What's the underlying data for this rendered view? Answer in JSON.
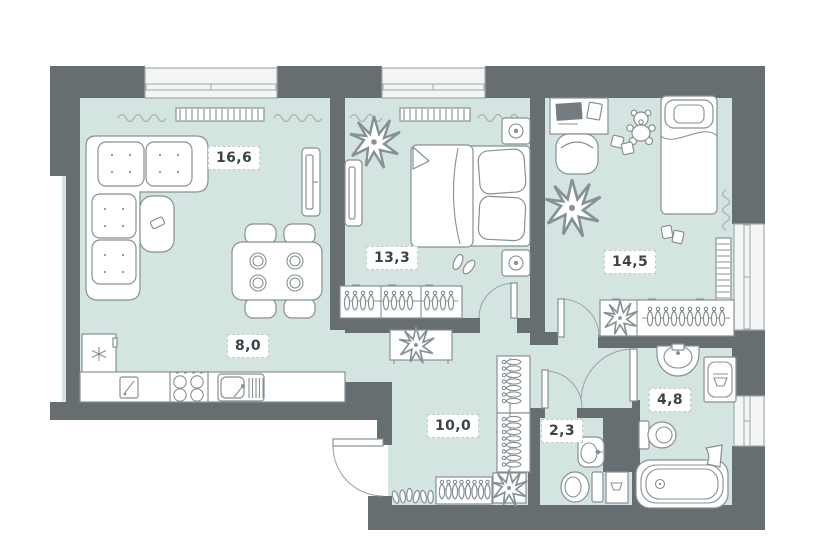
{
  "rooms": [
    {
      "id": "living-room",
      "area": "16,6"
    },
    {
      "id": "bedroom",
      "area": "13,3"
    },
    {
      "id": "kids-room",
      "area": "14,5"
    },
    {
      "id": "kitchen",
      "area": "8,0"
    },
    {
      "id": "hallway",
      "area": "10,0"
    },
    {
      "id": "wc",
      "area": "2,3"
    },
    {
      "id": "bathroom",
      "area": "4,8"
    }
  ],
  "colors": {
    "wall": "#676e72",
    "floor": "#d4e4e0",
    "window": "#f4f5f5",
    "outline": "#879093",
    "label_bg": "#ffffff",
    "label_border": "#bfc9c8",
    "label_text": "#3a444a"
  },
  "icons": [
    "sofa-icon",
    "coffee-table-icon",
    "tv-icon",
    "dining-table-icon",
    "chair-icon",
    "fridge-icon",
    "stove-icon",
    "sink-icon",
    "cutting-board-icon",
    "bed-double-icon",
    "bed-single-icon",
    "nightstand-icon",
    "lamp-icon",
    "wardrobe-icon",
    "hanger-icon",
    "plant-icon",
    "radiator-icon",
    "curtain-icon",
    "desk-icon",
    "monitor-icon",
    "teddy-bear-icon",
    "toy-blocks-icon",
    "slippers-icon",
    "shoes-icon",
    "coat-rack-icon",
    "console-table-icon",
    "toilet-icon",
    "washbasin-icon",
    "bathtub-icon",
    "washing-machine-icon",
    "water-heater-icon",
    "door-icon"
  ]
}
